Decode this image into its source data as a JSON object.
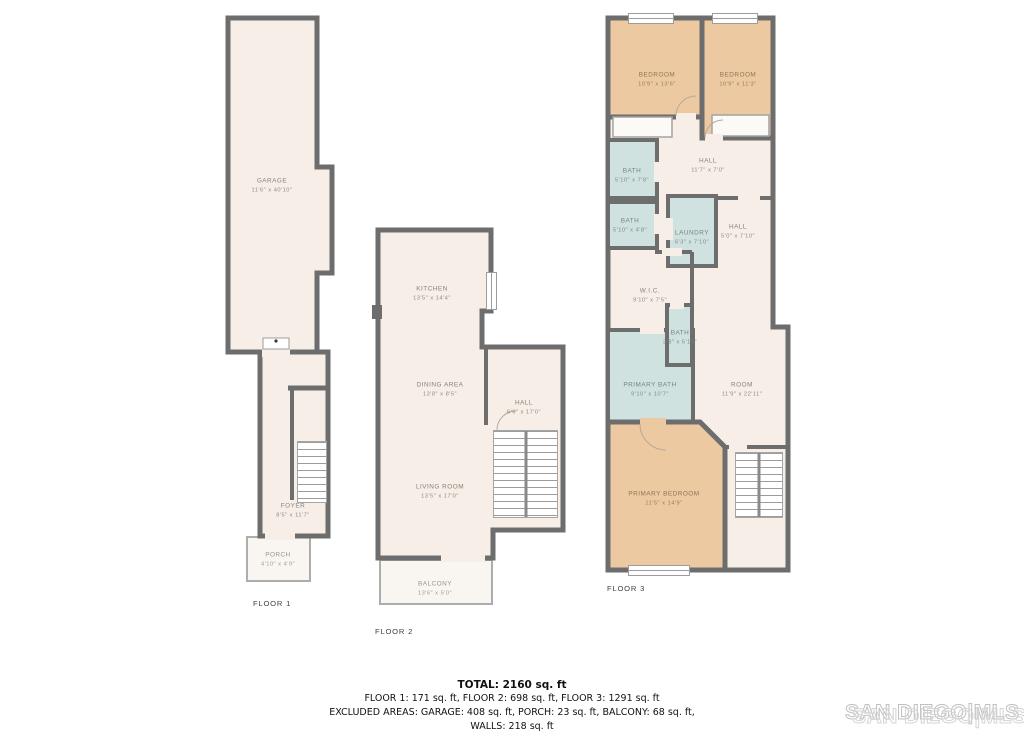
{
  "colors": {
    "wall": "#6d6d6d",
    "floor": "#f6eee7",
    "bedroom": "#edc9a2",
    "bath": "#cfe2df",
    "outdoor": "#f9f5f0",
    "watermark_stroke": "#c0c0c0"
  },
  "floors": [
    {
      "label": "FLOOR 1",
      "rooms": [
        {
          "name": "GARAGE",
          "dims": "11'6\" x 40'10\""
        },
        {
          "name": "FOYER",
          "dims": "8'5\" x 11'7\""
        },
        {
          "name": "PORCH",
          "dims": "4'10\" x 4'9\""
        }
      ]
    },
    {
      "label": "FLOOR 2",
      "rooms": [
        {
          "name": "KITCHEN",
          "dims": "13'5\" x 14'4\""
        },
        {
          "name": "DINING AREA",
          "dims": "13'8\" x 8'5\""
        },
        {
          "name": "LIVING ROOM",
          "dims": "13'5\" x 17'0\""
        },
        {
          "name": "HALL",
          "dims": "6'6\" x 17'0\""
        },
        {
          "name": "BALCONY",
          "dims": "13'6\" x 5'0\""
        }
      ]
    },
    {
      "label": "FLOOR 3",
      "rooms": [
        {
          "name": "BEDROOM",
          "dims": "10'9\" x 13'6\""
        },
        {
          "name": "BEDROOM",
          "dims": "10'9\" x 11'3\""
        },
        {
          "name": "BATH",
          "dims": "5'10\" x 7'8\""
        },
        {
          "name": "HALL",
          "dims": "11'7\" x 7'0\""
        },
        {
          "name": "BATH",
          "dims": "5'10\" x 4'8\""
        },
        {
          "name": "LAUNDRY",
          "dims": "6'3\" x 7'10\""
        },
        {
          "name": "HALL",
          "dims": "5'0\" x 7'10\""
        },
        {
          "name": "W.I.C.",
          "dims": "9'10\" x 7'5\""
        },
        {
          "name": "BATH",
          "dims": "3'8\" x 5'10\""
        },
        {
          "name": "PRIMARY BATH",
          "dims": "9'10\" x 10'7\""
        },
        {
          "name": "ROOM",
          "dims": "11'9\" x 22'11\""
        },
        {
          "name": "PRIMARY BEDROOM",
          "dims": "11'5\" x 14'9\""
        }
      ]
    }
  ],
  "summary": {
    "total": "TOTAL: 2160 sq. ft",
    "line1": "FLOOR 1: 171 sq. ft, FLOOR 2: 698 sq. ft, FLOOR 3: 1291 sq. ft",
    "line2": "EXCLUDED AREAS: GARAGE: 408 sq. ft, PORCH: 23 sq. ft, BALCONY: 68 sq. ft,",
    "line3": "WALLS: 218 sq. ft"
  },
  "watermark": {
    "text": "SAN DIEGO|MLS"
  }
}
